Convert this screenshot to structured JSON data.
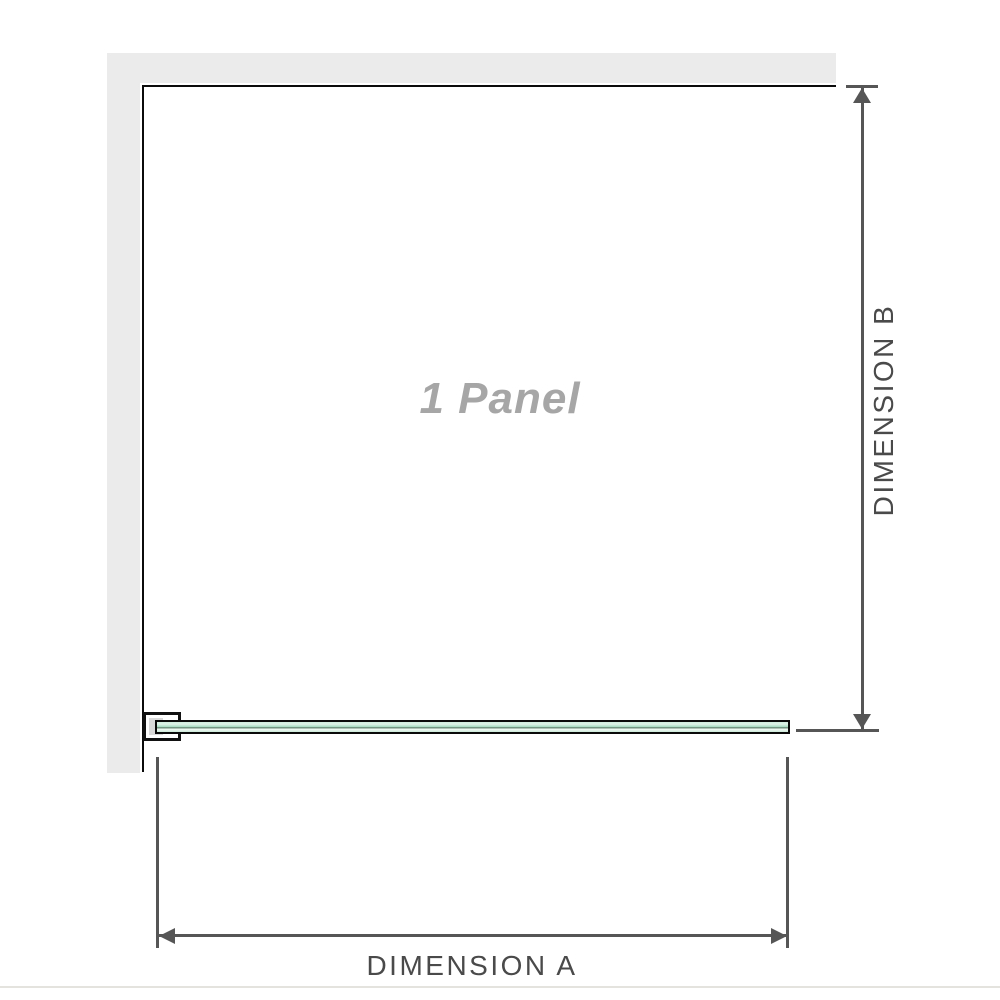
{
  "labels": {
    "panel": "1 Panel",
    "dimension_a": "DIMENSION A",
    "dimension_b": "DIMENSION B"
  },
  "colors": {
    "wall_fill": "#ebebeb",
    "edge_outline": "#0b0b0b",
    "dimension_gray": "#565656",
    "dimension_label_gray": "#4a4a4a",
    "panel_label_gray": "#a6a6a6",
    "glass_green_light": "#ddf2e7",
    "glass_green_mid": "#a9dcc3",
    "glass_green_dark": "#5b7765",
    "bracket_fill": "#ffffff",
    "bracket_inner_fill": "#d9d9d9",
    "bottom_divider": "#e5e3de"
  }
}
